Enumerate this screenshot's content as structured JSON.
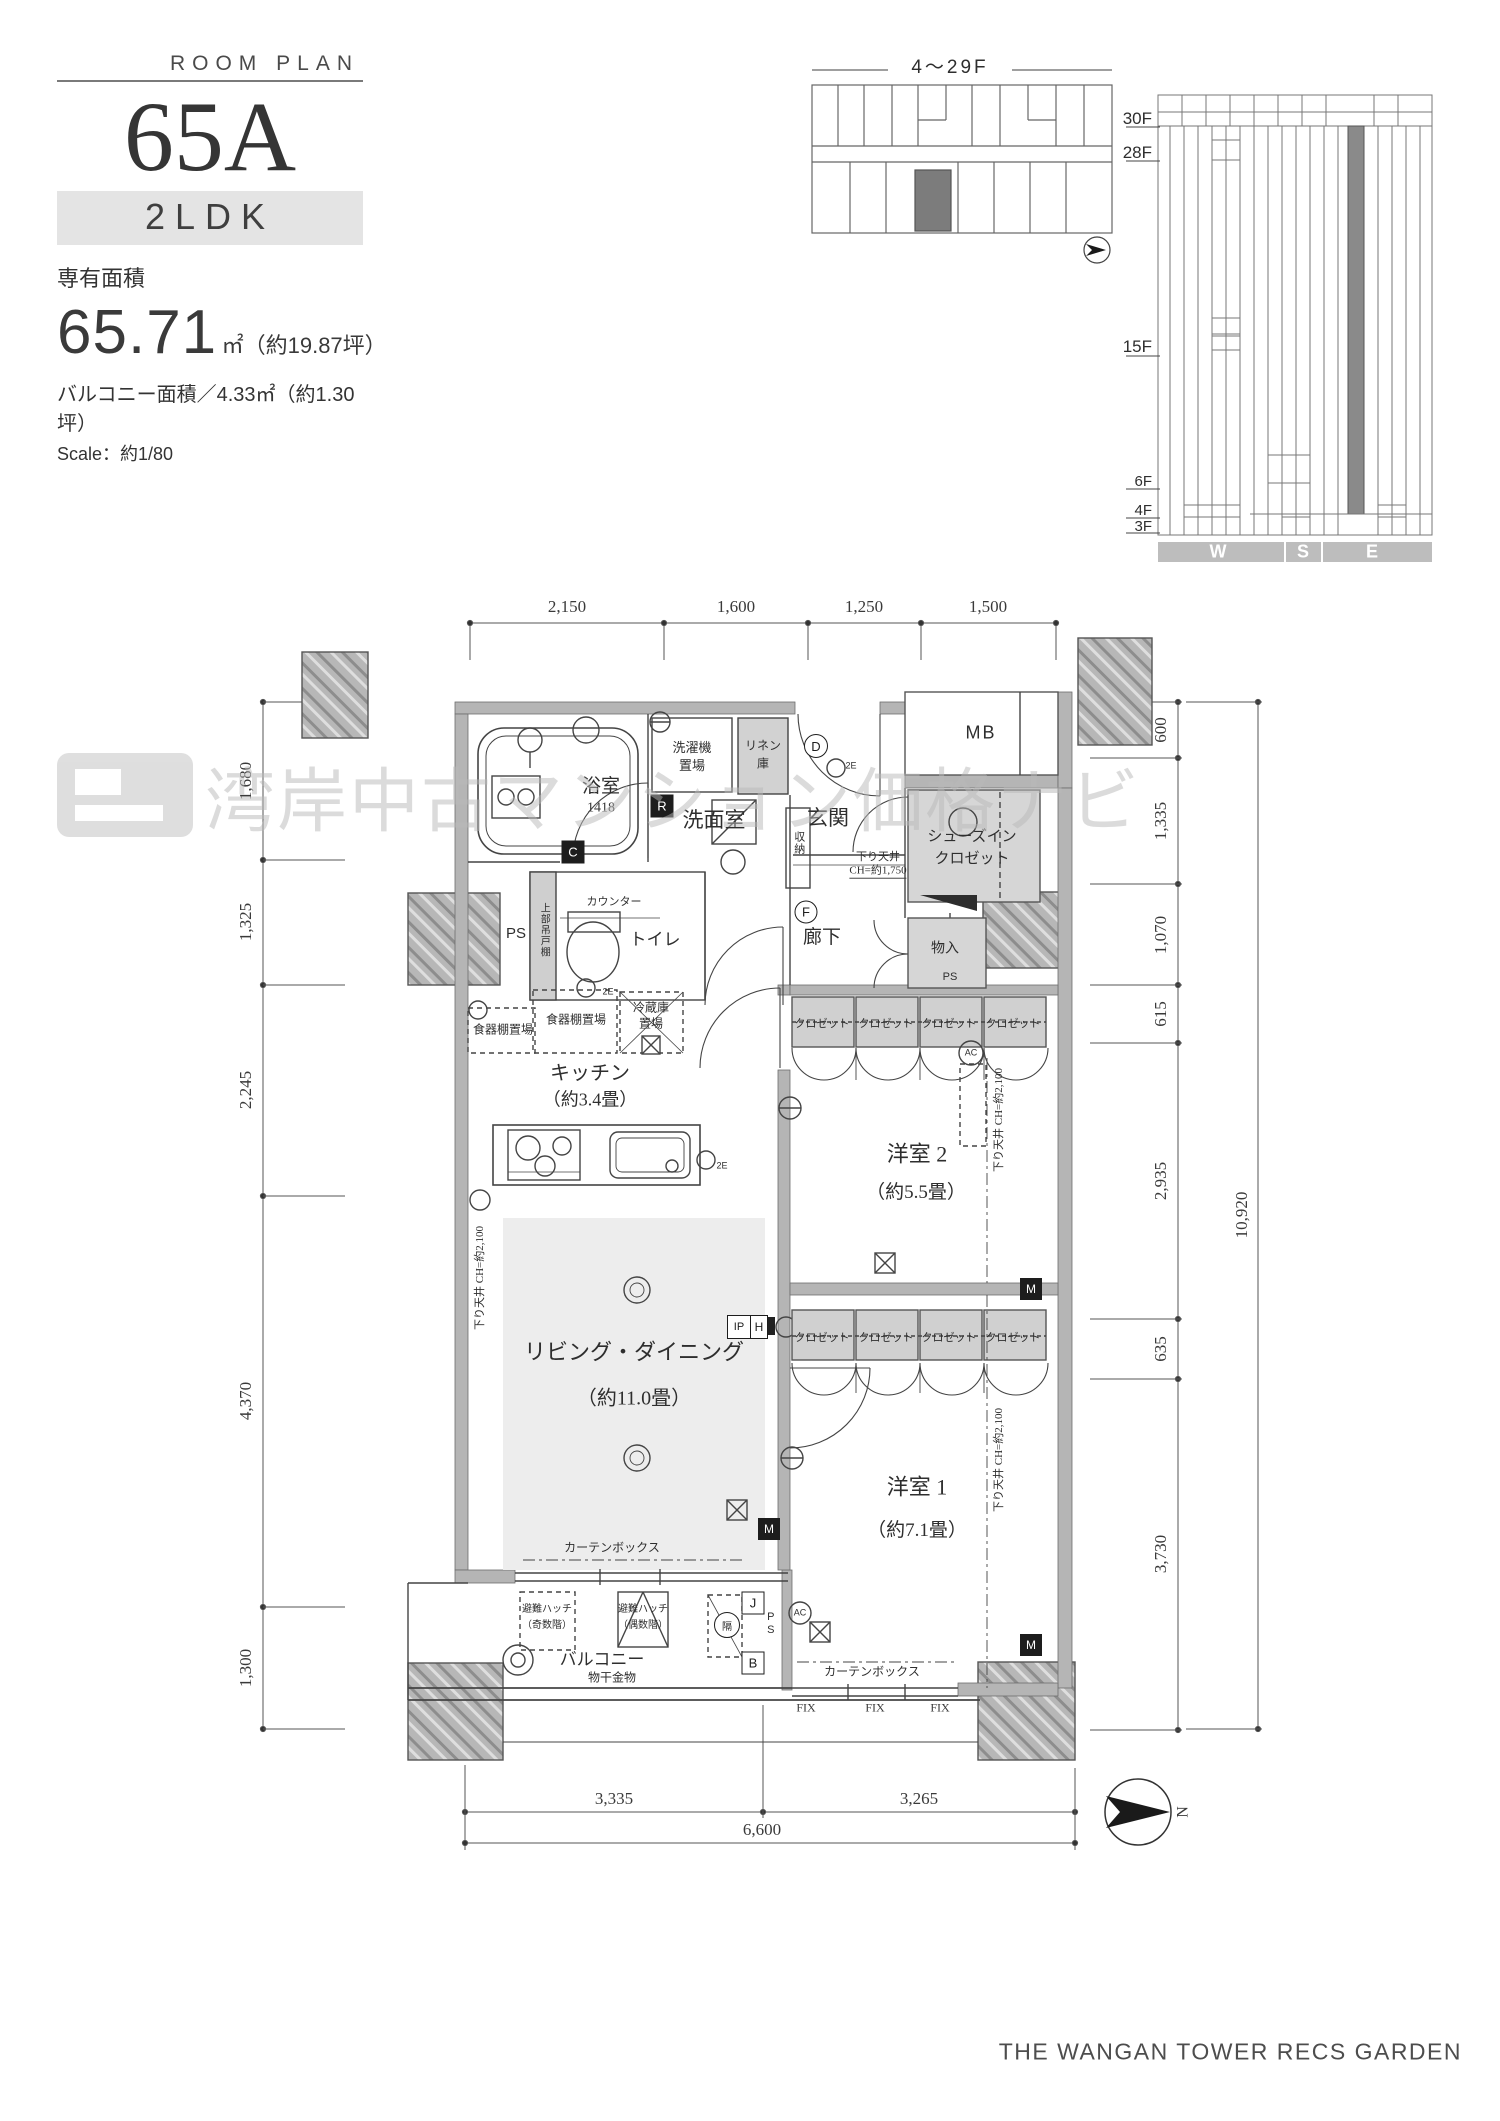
{
  "header": {
    "eyebrow": "ROOM PLAN",
    "unit_name": "65A",
    "layout_type": "2LDK",
    "area_caption": "専有面積",
    "area_value": "65.71",
    "area_suffix": "㎡（約19.87坪）",
    "balcony_line": "バルコニー面積／4.33㎡（約1.30坪）",
    "scale_line": "Scale：約1/80"
  },
  "key_plan": {
    "caption": "4～29F"
  },
  "elevation": {
    "floor_labels": [
      "30F",
      "28F",
      "15F",
      "6F",
      "4F",
      "3F"
    ],
    "direction_labels": [
      "W",
      "S",
      "E"
    ]
  },
  "compass": {
    "north_label": "N"
  },
  "dimensions": {
    "top": [
      "2,150",
      "1,600",
      "1,250",
      "1,500"
    ],
    "left": [
      "1,680",
      "1,325",
      "2,245",
      "4,370",
      "1,300"
    ],
    "right": [
      "600",
      "1,335",
      "1,070",
      "615",
      "2,935",
      "635",
      "3,730"
    ],
    "right_total": "10,920",
    "bottom": [
      "3,335",
      "3,265"
    ],
    "bottom_total": "6,600"
  },
  "rooms": {
    "bathroom": "浴室",
    "bathroom_size": "1418",
    "washer_l1": "洗濯機",
    "washer_l2": "置場",
    "linen_l1": "リネン",
    "linen_l2": "庫",
    "washroom": "洗面室",
    "storage_small": "収納",
    "entrance": "玄関",
    "shoes_l1": "シューズイン",
    "shoes_l2": "クロゼット",
    "mb": "MB",
    "storage": "物入",
    "corridor": "廊下",
    "toilet": "トイレ",
    "counter": "カウンター",
    "upper_cabinet": "上部吊戸棚",
    "ps": "PS",
    "dish_shelf": "食器棚置場",
    "fridge_l1": "冷蔵庫",
    "fridge_l2": "置場",
    "kitchen": "キッチン",
    "kitchen_size": "（約3.4畳）",
    "living": "リビング・ダイニング",
    "living_size": "（約11.0畳）",
    "bedroom2": "洋室 2",
    "bedroom2_size": "（約5.5畳）",
    "bedroom1": "洋室 1",
    "bedroom1_size": "（約7.1畳）",
    "closet": "クロゼット",
    "balcony": "バルコニー",
    "laundry_pole": "物干金物",
    "hatch_odd_l1": "避難ハッチ",
    "hatch_odd_l2": "（奇数階）",
    "hatch_even_l1": "避難ハッチ",
    "hatch_even_l2": "（偶数階）",
    "curtain_box": "カーテンボックス",
    "fix": "FIX",
    "lowered_1750_l1": "下り天井",
    "lowered_1750_l2": "CH=約1,750",
    "lowered_2100": "下り天井 CH=約2,100"
  },
  "markers": {
    "r": "R",
    "c": "C",
    "d": "D",
    "f": "F",
    "j": "J",
    "b": "B",
    "m": "M",
    "h": "H",
    "ip": "IP",
    "ac": "AC",
    "heki": "隔",
    "two_e": "2E"
  },
  "watermark": {
    "text": "湾岸中古マンション価格ナビ"
  },
  "footer": {
    "brand": "THE WANGAN TOWER  RECS GARDEN"
  }
}
